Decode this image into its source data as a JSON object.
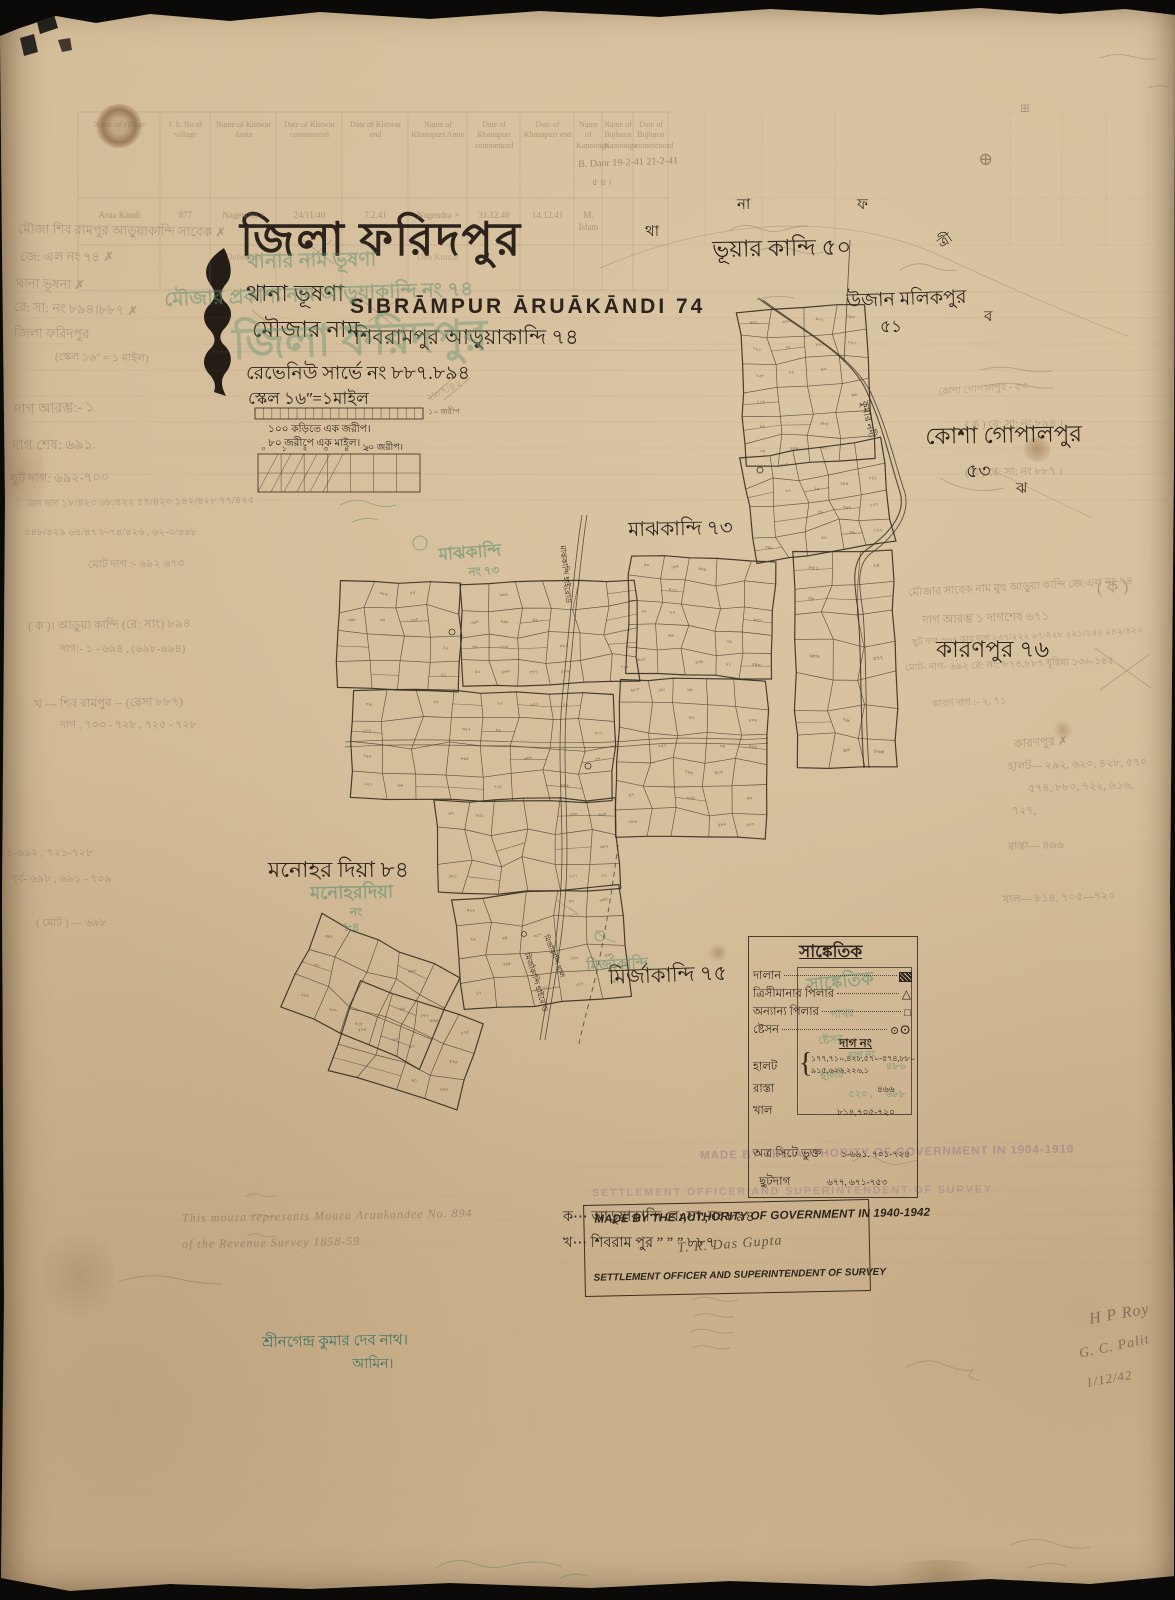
{
  "sheet": {
    "title_district": "জিলা ফরিদপুর",
    "thana_line": "থানা ভূষণা",
    "mouza_label": "মৌজার নাম",
    "name_en": "SIBRĀMPUR ĀRUĀKĀNDI 74",
    "name_bn": "শিবরামপুর আড়ুয়াকান্দি ৭৪",
    "revenue_line": "রেভেনিউ সার্ভে নং ৮৮৭.৮৯৪",
    "scale_line": "স্কেল ১৬ʺ=১মাইল",
    "scale_caption1": "১০০ কড়িতে এক জরীপ।",
    "scale_caption2": "৮০ জরীপে এক মাইল।",
    "scale_numbers": "০ ১ ২ ৩ ৪ ৫",
    "scale_right_label": "১০ জরীপ।",
    "scale_bar_label": "১০ জরীপ"
  },
  "table": {
    "headers": [
      "Name of village",
      "J. h. No of village",
      "Name of Kistwar Amin",
      "Date of Kistwar commenced",
      "Date of Kistwar end",
      "Name of Khanapuri Amin",
      "Date of Khanapuri commenced",
      "Date of Khanapuri end",
      "Name of Kanoongo",
      "Name of Bujharat Kanoongo",
      "Date of Bujharat commenced"
    ],
    "row1": [
      "Arua Kandi",
      "877",
      "Nagendra ×",
      "24/11/40",
      "7.2.41",
      "Nagendra ×",
      "31.12.40",
      "14.12.41",
      "M. Islam",
      "",
      ""
    ],
    "row2": [
      "",
      "",
      "Debendra",
      "",
      "",
      "Deb Kumar",
      "",
      "",
      "",
      "",
      ""
    ]
  },
  "map_labels": [
    {
      "t": "ভূয়ার কান্দি ৫০",
      "x": 712,
      "y": 238,
      "s": 23,
      "rot": -1,
      "n": "village-label-bhuar-kandi-50"
    },
    {
      "t": "উজান মলিকপুর",
      "x": 846,
      "y": 292,
      "s": 19,
      "rot": -2,
      "n": "village-label-ujan-malikpur"
    },
    {
      "t": "৫১",
      "x": 880,
      "y": 318,
      "s": 17,
      "n": "village-number-51"
    },
    {
      "t": "কোশা গোপালপুর",
      "x": 925,
      "y": 425,
      "s": 23,
      "rot": -1,
      "n": "village-label-kosha-gopalpur"
    },
    {
      "t": "৫৩",
      "x": 966,
      "y": 462,
      "s": 19,
      "n": "village-number-53"
    },
    {
      "t": "মাঝকান্দি ৭৩",
      "x": 628,
      "y": 520,
      "s": 20,
      "rot": -1,
      "n": "village-label-majhkandi-73"
    },
    {
      "t": "কারণপুর ৭৬",
      "x": 936,
      "y": 638,
      "s": 23,
      "n": "village-label-karanpur-76"
    },
    {
      "t": "মনোহর দিয়া ৮৪",
      "x": 268,
      "y": 858,
      "s": 22,
      "n": "village-label-manohar-dia-84"
    },
    {
      "t": "মির্জাকান্দি ৭৫",
      "x": 608,
      "y": 966,
      "s": 21,
      "rot": -2,
      "n": "village-label-mirzakandi-75"
    },
    {
      "t": "থা",
      "x": 645,
      "y": 225,
      "s": 15,
      "n": "boundary-letter-tha"
    },
    {
      "t": "না",
      "x": 737,
      "y": 198,
      "s": 15,
      "n": "boundary-letter-na"
    },
    {
      "t": "ফ",
      "x": 857,
      "y": 198,
      "s": 15,
      "n": "boundary-letter-pha"
    },
    {
      "t": "ত্রী",
      "x": 936,
      "y": 240,
      "s": 14,
      "rot": -35,
      "n": "boundary-letter-tri"
    },
    {
      "t": "ব",
      "x": 984,
      "y": 310,
      "s": 15,
      "n": "boundary-letter-ba"
    },
    {
      "t": "ঝ",
      "x": 1016,
      "y": 482,
      "s": 15,
      "n": "boundary-letter-jha"
    },
    {
      "t": "কুমার নদী",
      "x": 868,
      "y": 400,
      "s": 10,
      "rot": 78,
      "n": "river-label-kumar-nadi"
    },
    {
      "t": "মাঝকান্দি হাইরোড",
      "x": 566,
      "y": 545,
      "s": 8,
      "rot": 84,
      "n": "road-label-majhkandi-highroad"
    },
    {
      "t": "মির্জাকান্দি হাইরোড",
      "x": 530,
      "y": 952,
      "s": 8,
      "rot": 72,
      "n": "road-label-mirzakandi-highroad"
    },
    {
      "t": "মির্জাকান্দি খাল",
      "x": 549,
      "y": 934,
      "s": 7.5,
      "rot": 68,
      "n": "canal-label-mirzakandi-khal"
    }
  ],
  "green_stamps": [
    {
      "t": "থানার নাম ভূষণা",
      "x": 246,
      "y": 252,
      "s": 20,
      "rot": -1,
      "o": 0.5,
      "n": "green-stamp-thana-name"
    },
    {
      "t": "মৌজার প্রকাশ্য নাম আড়ুয়াকান্দি নং ৭৪",
      "x": 164,
      "y": 290,
      "s": 20,
      "rot": -2,
      "o": 0.5,
      "n": "green-stamp-mouza-name"
    },
    {
      "t": "জিলা ফরিদপুর",
      "x": 232,
      "y": 322,
      "s": 44,
      "rot": -2,
      "o": 0.4,
      "n": "green-stamp-district"
    },
    {
      "t": "মাঝকান্দি",
      "x": 438,
      "y": 546,
      "s": 17,
      "rot": -4,
      "o": 0.6,
      "n": "green-stamp-majhkandi"
    },
    {
      "t": "নং ৭৩",
      "x": 468,
      "y": 566,
      "s": 12,
      "rot": -4,
      "o": 0.6,
      "n": "green-stamp-majhkandi-no"
    },
    {
      "t": "মনোহরদিয়া",
      "x": 310,
      "y": 884,
      "s": 18,
      "rot": -1,
      "o": 0.6,
      "n": "green-stamp-manohardia"
    },
    {
      "t": "নং",
      "x": 350,
      "y": 906,
      "s": 12,
      "o": 0.6,
      "n": "green-stamp-manohardia-no"
    },
    {
      "t": "৮৪",
      "x": 344,
      "y": 921,
      "s": 12,
      "o": 0.6,
      "n": "green-stamp-manohardia-84"
    },
    {
      "t": "মির্জাকান্দি",
      "x": 586,
      "y": 960,
      "s": 15,
      "rot": -3,
      "o": 0.55,
      "n": "green-stamp-mirzakandi"
    },
    {
      "t": "সাঙ্কেতিক",
      "x": 806,
      "y": 976,
      "s": 18,
      "rot": -6,
      "o": 0.55,
      "n": "green-stamp-legend-heading"
    },
    {
      "t": "পাথর",
      "x": 830,
      "y": 1010,
      "s": 11,
      "rot": -4,
      "o": 0.5,
      "n": "green-stamp-pathor"
    },
    {
      "t": "ষ্টেসন",
      "x": 818,
      "y": 1036,
      "s": 11,
      "rot": -4,
      "o": 0.5,
      "n": "green-stamp-station"
    },
    {
      "t": "দাগ নং",
      "x": 848,
      "y": 1052,
      "s": 10,
      "rot": -4,
      "o": 0.5,
      "n": "green-stamp-dag-no"
    },
    {
      "t": "হালট",
      "x": 820,
      "y": 1072,
      "s": 11,
      "rot": -6,
      "o": 0.5,
      "n": "green-stamp-halot"
    },
    {
      "t": "৪৮৬",
      "x": 886,
      "y": 1062,
      "s": 10,
      "o": 0.5,
      "n": "green-stamp-number-1"
    },
    {
      "t": "৫২০ ,",
      "x": 848,
      "y": 1090,
      "s": 10,
      "o": 0.5,
      "n": "green-stamp-number-2"
    },
    {
      "t": "৬৮৮",
      "x": 886,
      "y": 1090,
      "s": 10,
      "o": 0.5,
      "n": "green-stamp-number-3"
    }
  ],
  "pencil_notes": [
    {
      "t": "মৌজা শিব রামপুর আড়ুয়াকান্দি সাবেক ✗",
      "x": 18,
      "y": 222,
      "s": 13,
      "rot": 1,
      "n": "margin-note-mouza"
    },
    {
      "t": "জে: এল নং  ৭৪  ✗",
      "x": 20,
      "y": 250,
      "s": 13,
      "n": "margin-note-jl-no"
    },
    {
      "t": "থানা  ভূষনা  ✗",
      "x": 16,
      "y": 276,
      "s": 13,
      "rot": 2,
      "n": "margin-note-thana"
    },
    {
      "t": "রে: সা: নং ৮৯৪।৮৮৭  ✗",
      "x": 14,
      "y": 300,
      "s": 13,
      "rot": 2,
      "n": "margin-note-rs-no"
    },
    {
      "t": "জিলা ফরিদপুর",
      "x": 14,
      "y": 326,
      "s": 13,
      "rot": 1,
      "n": "margin-note-district"
    },
    {
      "t": "(স্কেল ১৬ʺ = ১ মাইল)",
      "x": 55,
      "y": 352,
      "s": 11,
      "rot": 1,
      "n": "margin-note-scale"
    },
    {
      "t": "দাগ আরম্ভ:-   ১",
      "x": 14,
      "y": 404,
      "s": 14,
      "rot": -2,
      "n": "margin-note-dag-start"
    },
    {
      "t": "দাগ শেষ:   ৬৯১",
      "x": 12,
      "y": 440,
      "s": 14,
      "rot": -1,
      "n": "margin-note-dag-end"
    },
    {
      "t": "ছুট দাগ:  ৬৯২-৭০০",
      "x": 10,
      "y": 472,
      "s": 13,
      "rot": -1,
      "n": "margin-note-chhut-dag"
    },
    {
      "t": "বাদ দাগ  ১৮/৪২৩  ৬৮/৪২২  ৫৭/৪২০  ১৪২/৪২৮  ৭৭/৪২৫",
      "x": 28,
      "y": 500,
      "s": 10,
      "rot": -1,
      "n": "margin-note-bad-dag"
    },
    {
      "t": "৪৪৮/৪২৯   ৬৪/৪৭   ৮-৭৪/৪২৬ ,   ৬২-০/৪৪৮",
      "x": 24,
      "y": 528,
      "s": 10,
      "n": "margin-note-fractions"
    },
    {
      "t": "মোট দাগ :-  ৬৯২  ৬৭৩",
      "x": 88,
      "y": 560,
      "s": 11,
      "rot": -1,
      "n": "margin-note-total-dag"
    },
    {
      "t": "( ক )।  আড়ুয়া কান্দি (রে: সাং)  ৮৯৪",
      "x": 28,
      "y": 620,
      "s": 12,
      "rot": -1,
      "n": "margin-note-ka"
    },
    {
      "t": "দাগ:-  ১ -  ৬৯৪ ,  (৬৯৮-৬৯৪)",
      "x": 60,
      "y": 644,
      "s": 11,
      "n": "margin-note-ka-dag"
    },
    {
      "t": "খ ---  শিব রামপুর -- (রেসা ৮৮৭)",
      "x": 34,
      "y": 698,
      "s": 12,
      "rot": -1,
      "n": "margin-note-kha"
    },
    {
      "t": "দাগ ,  ৭০৩ - ৭২৮ ,  ৭২৫ - ৭২৮",
      "x": 60,
      "y": 720,
      "s": 11,
      "n": "margin-note-kha-dag"
    },
    {
      "t": "১-৬৯২ ,  ৭২১-৭২৮",
      "x": 6,
      "y": 848,
      "s": 11,
      "n": "margin-note-range-1"
    },
    {
      "t": "পূর্ব- ৬৯৮ ,  ৬৯১ - ৭০৯",
      "x": 10,
      "y": 874,
      "s": 11,
      "n": "margin-note-range-2"
    },
    {
      "t": "( মোট ) — ৬৯৮",
      "x": 36,
      "y": 918,
      "s": 11,
      "n": "margin-note-range-3"
    },
    {
      "t": "B. Danr  19-2-41   21-2-41",
      "x": 578,
      "y": 160,
      "s": 10,
      "rot": -2,
      "o": 0.7,
      "n": "table-annotation-danr"
    },
    {
      "t": "৫ ৪ ।",
      "x": 592,
      "y": 178,
      "s": 9,
      "o": 0.7,
      "n": "table-annotation-54"
    },
    {
      "t": "⊕",
      "x": 978,
      "y": 150,
      "s": 18,
      "o": 0.75,
      "n": "circled-plus-mark"
    },
    {
      "t": "⊞",
      "x": 1020,
      "y": 102,
      "s": 12,
      "o": 0.5,
      "n": "boxed-plus-mark"
    },
    {
      "t": "( ক )   রে: সা: নং  ৮৯৪ ।",
      "x": 965,
      "y": 420,
      "s": 11,
      "rot": -1,
      "n": "note-ka-rs-894"
    },
    {
      "t": "( খ )   রে: সা: নং  ৮৮৭ ।",
      "x": 965,
      "y": 468,
      "s": 11,
      "rot": -1,
      "n": "note-kha-rs-887"
    },
    {
      "t": "কোশা গোপালপুর - ৫৩",
      "x": 938,
      "y": 388,
      "s": 10,
      "rot": -4,
      "o": 0.45,
      "n": "pencil-kosha-gopalpur"
    },
    {
      "t": "২৮/৭/৪২",
      "x": 425,
      "y": 395,
      "s": 10,
      "rot": -25,
      "o": 0.5,
      "n": "pencil-date-note"
    },
    {
      "t": "মৌজার সাবেক নাম মুহু আড়ুয়া কান্দি  জে:এল নং ৭৪",
      "x": 908,
      "y": 588,
      "s": 11,
      "rot": -3,
      "n": "right-note-former-name"
    },
    {
      "t": "( ক )",
      "x": 1096,
      "y": 580,
      "s": 17,
      "rot": -5,
      "n": "right-note-ka-circled"
    },
    {
      "t": "দাগ আরম্ভ  ১    দাগশেষ  ৬৭১",
      "x": 922,
      "y": 614,
      "s": 12,
      "rot": -2,
      "n": "right-note-dag-range"
    },
    {
      "t": "ছুট দাগ ৩৩৭  কার দাগ  ২৩৭/২২২  ৬৭/৪২৮  ২২১/২৪২  ২৪২/৪২০",
      "x": 912,
      "y": 638,
      "s": 9,
      "rot": -3,
      "n": "right-note-chhut"
    },
    {
      "t": "মোট- দাগ- ৬৯২   রে: সং: ৮৭৪,৮৮৭   ধূরিয়া ১৩৬-১৪৫",
      "x": 905,
      "y": 664,
      "s": 10,
      "rot": -2,
      "n": "right-note-total"
    },
    {
      "t": "কারণ দাগ :-  ২, ৭১",
      "x": 932,
      "y": 700,
      "s": 10,
      "rot": -3,
      "n": "right-note-karan-dag"
    },
    {
      "t": "কারণপুর ✗",
      "x": 1014,
      "y": 738,
      "s": 12,
      "rot": -4,
      "n": "right-note-karanpur-crossed"
    },
    {
      "t": "হালট— ২৯২, ৬২০, ৪২৮, ৫৭০",
      "x": 1008,
      "y": 762,
      "s": 11,
      "rot": -2,
      "n": "right-note-halot-1"
    },
    {
      "t": "৫৭৪, ৮৮০, ৭২২, ৬১৬,",
      "x": 1028,
      "y": 784,
      "s": 11,
      "rot": -2,
      "n": "right-note-halot-2"
    },
    {
      "t": "৭২৭,",
      "x": 1012,
      "y": 806,
      "s": 11,
      "n": "right-note-halot-3"
    },
    {
      "t": "রাস্তা—  ৪৬৬",
      "x": 1008,
      "y": 842,
      "s": 11,
      "rot": -2,
      "n": "right-note-rasta"
    },
    {
      "t": "খাল— ৮১৪, ৭০৫—৭২০",
      "x": 1002,
      "y": 895,
      "s": 11,
      "rot": -2,
      "n": "right-note-khal"
    }
  ],
  "signatures": [
    {
      "t": "H P Roy",
      "x": 1088,
      "y": 1312,
      "s": 16,
      "rot": -10,
      "n": "signature-hp-roy"
    },
    {
      "t": "G. C. Palit",
      "x": 1078,
      "y": 1348,
      "s": 14,
      "rot": -12,
      "n": "signature-gc-palit"
    },
    {
      "t": "1/12/42",
      "x": 1085,
      "y": 1376,
      "s": 13,
      "rot": -10,
      "n": "signature-date"
    }
  ],
  "legend": {
    "heading": "সাঙ্কেতিক",
    "rows": [
      {
        "label": "দালান"
      },
      {
        "label": "ত্রিসীমানার পিলার"
      },
      {
        "label": "অন্যান্য পিলার"
      },
      {
        "label": "ষ্টেসন"
      }
    ],
    "dag_heading": "দাগ নং",
    "halot_label": "হালট",
    "halot_values_1": "১৭৭,৭১০,৪২৮,৫৭০-৫৭৪,৮৮০",
    "halot_values_2": "৯১৫,৬২৬,২২৬,১",
    "rasta_label": "রাস্তা",
    "rasta_value": "৪৬৬",
    "khal_label": "খাল",
    "khal_value": "৮১৪,৭০৫-৭২০",
    "atra_label": "অত্র সিটে ভুক্ত",
    "atra_value": "১-৬৯১. ৭০১-৭২৪",
    "chhut_label": "ছুটদাগ",
    "chhut_value": "৬৭৭, ৬৭১-৭৫৩"
  },
  "stamps": {
    "made_by": "MADE BY THE AUTHORITY OF GOVERNMENT IN 1940-1942",
    "signature": "T. R. Das Gupta",
    "officer": "SETTLEMENT OFFICER AND SUPERINTENDENT OF SURVEY",
    "faded_made_by": "MADE BY THE AUTHORITY OF GOVERNMENT IN 1904-1910",
    "faded_officer": "SETTLEMENT OFFICER AND SUPERINTENDENT OF SURVEY"
  },
  "footnotes": {
    "english1": "This mouza represents Mouza Aruakandee No. 894",
    "english2": "of the Revenue Survey 1858-59",
    "ka_line": "ক⋯ আড়ুয়াকান্দি রে:,সা:,নং ৮৯৪",
    "kha_line": "খ⋯ শিবরাম পুর   ”   ”   ”   ৮৮৭",
    "amin_name": "শ্রীনগেন্দ্র কুমার দেব নাথ।",
    "amin_title": "আমিন।"
  }
}
